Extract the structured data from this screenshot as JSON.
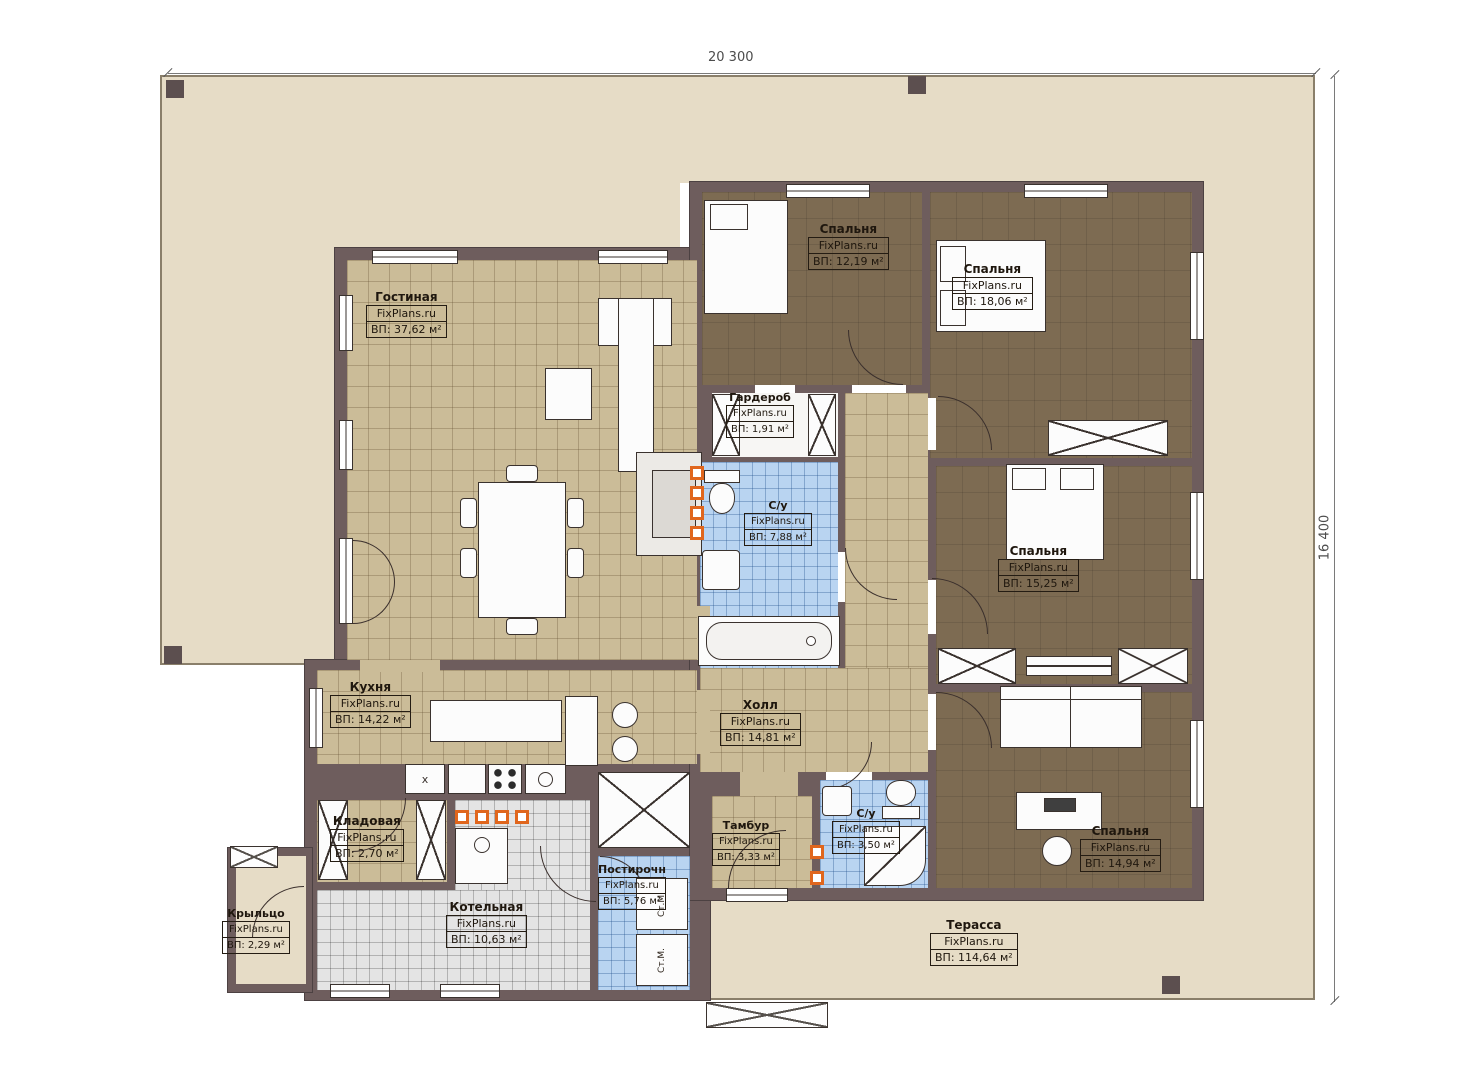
{
  "plan": {
    "title": "single-storey house floor plan",
    "dimensions": {
      "width_label": "20 300",
      "height_label": "16 400"
    },
    "rooms": [
      {
        "id": "living",
        "name": "Гостиная",
        "watermark": "FixPlans.ru",
        "area": "ВП: 37,62 м²"
      },
      {
        "id": "bedroom-1",
        "name": "Спальня",
        "watermark": "FixPlans.ru",
        "area": "ВП: 12,19 м²"
      },
      {
        "id": "bedroom-2",
        "name": "Спальня",
        "watermark": "FixPlans.ru",
        "area": "ВП: 18,06 м²"
      },
      {
        "id": "wardrobe",
        "name": "Гардероб",
        "watermark": "FixPlans.ru",
        "area": "ВП: 1,91 м²"
      },
      {
        "id": "bathroom-1",
        "name": "С/у",
        "watermark": "FixPlans.ru",
        "area": "ВП: 7,88 м²"
      },
      {
        "id": "bedroom-3",
        "name": "Спальня",
        "watermark": "FixPlans.ru",
        "area": "ВП: 15,25 м²"
      },
      {
        "id": "kitchen",
        "name": "Кухня",
        "watermark": "FixPlans.ru",
        "area": "ВП: 14,22 м²"
      },
      {
        "id": "hall",
        "name": "Холл",
        "watermark": "FixPlans.ru",
        "area": "ВП: 14,81 м²"
      },
      {
        "id": "pantry",
        "name": "Кладовая",
        "watermark": "FixPlans.ru",
        "area": "ВП: 2,70 м²"
      },
      {
        "id": "vestibule",
        "name": "Тамбур",
        "watermark": "FixPlans.ru",
        "area": "ВП: 3,33 м²"
      },
      {
        "id": "bathroom-2",
        "name": "С/у",
        "watermark": "FixPlans.ru",
        "area": "ВП: 3,50 м²"
      },
      {
        "id": "bedroom-4",
        "name": "Спальня",
        "watermark": "FixPlans.ru",
        "area": "ВП: 14,94 м²"
      },
      {
        "id": "boiler",
        "name": "Котельная",
        "watermark": "FixPlans.ru",
        "area": "ВП: 10,63 м²"
      },
      {
        "id": "laundry",
        "name": "Постирочн",
        "watermark": "FixPlans.ru",
        "area": "ВП: 5,76 м²"
      },
      {
        "id": "porch",
        "name": "Крыльцо",
        "watermark": "FixPlans.ru",
        "area": "ВП: 2,29 м²"
      },
      {
        "id": "terrace",
        "name": "Терасса",
        "watermark": "FixPlans.ru",
        "area": "ВП: 114,64 м²"
      }
    ],
    "appliances": {
      "washer_label": "Ст.М.",
      "fridge_label": "x"
    },
    "colors": {
      "yard": "#e6dcc6",
      "wall": "#6e5d5d",
      "floor_wood": "#cbbc98",
      "floor_bedroom": "#7d6b52",
      "floor_tile_blue": "#b9d4f1",
      "floor_tile_gray": "#e4e4e4",
      "vent_accent": "#e0661d"
    }
  }
}
